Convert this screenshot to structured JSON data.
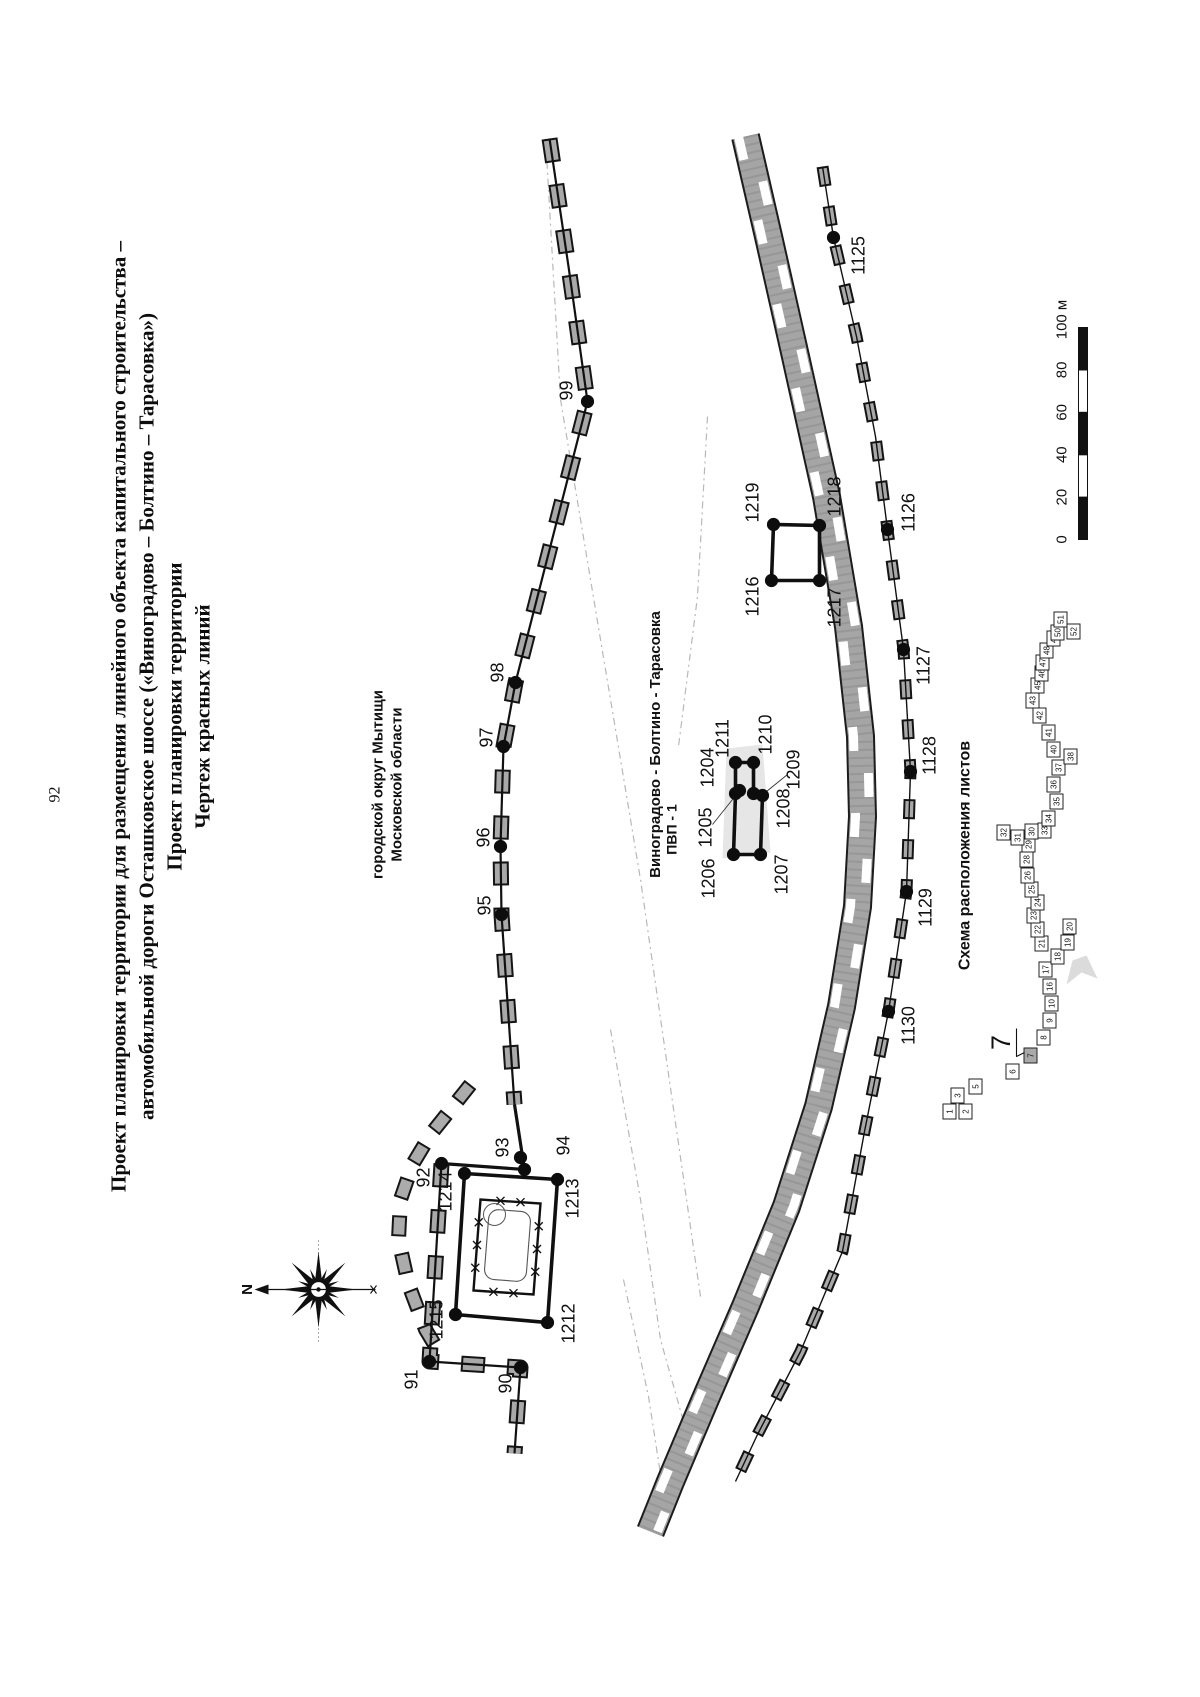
{
  "page": {
    "number": "92"
  },
  "title": {
    "line1": "Проект планировки территории для размещения линейного объекта капитального строительства –",
    "line2": "автомобильной дороги Осташковское шоссе («Виноградово – Болтино – Тарасовка»)",
    "line3": "Проект планировки территории",
    "line4": "Чертеж красных линий"
  },
  "map": {
    "district_label_line1": "городской округ Мытищи",
    "district_label_line2": "Московской области",
    "route_label": "Виноградово - Болтино - Тарасовка",
    "pvp_label": "ПВП - 1",
    "compass_label": "N",
    "points": [
      {
        "label": "90",
        "x": 329,
        "y": 520,
        "lx": 313,
        "ly": 505
      },
      {
        "label": "91",
        "x": 335,
        "y": 429,
        "lx": 317,
        "ly": 411
      },
      {
        "label": "92",
        "x": 533,
        "y": 441,
        "lx": 519,
        "ly": 423
      },
      {
        "label": "93",
        "x": 539,
        "y": 520,
        "lx": 549,
        "ly": 502
      },
      {
        "label": "94",
        "x": 527,
        "y": 524,
        "lx": 551,
        "ly": 563
      },
      {
        "label": "95",
        "x": 782,
        "y": 501,
        "lx": 791,
        "ly": 484
      },
      {
        "label": "96",
        "x": 850,
        "y": 500,
        "lx": 859,
        "ly": 483
      },
      {
        "label": "97",
        "x": 950,
        "y": 503,
        "lx": 959,
        "ly": 486
      },
      {
        "label": "98",
        "x": 1014,
        "y": 515,
        "lx": 1024,
        "ly": 497
      },
      {
        "label": "99",
        "x": 1295,
        "y": 587,
        "lx": 1306,
        "ly": 566
      },
      {
        "label": "1125",
        "x": 1459,
        "y": 833,
        "lx": 1441,
        "ly": 858
      },
      {
        "label": "1126",
        "x": 1167,
        "y": 887,
        "lx": 1184,
        "ly": 908
      },
      {
        "label": "1127",
        "x": 1047,
        "y": 903,
        "lx": 1031,
        "ly": 923
      },
      {
        "label": "1128",
        "x": 925,
        "y": 910,
        "lx": 941,
        "ly": 929
      },
      {
        "label": "1129",
        "x": 805,
        "y": 906,
        "lx": 789,
        "ly": 925
      },
      {
        "label": "1130",
        "x": 685,
        "y": 888,
        "lx": 671,
        "ly": 908
      },
      {
        "label": "1204",
        "x": 903,
        "y": 735,
        "lx": 929,
        "ly": 707
      },
      {
        "label": "1205",
        "x": 906,
        "y": 739,
        "lx": 869,
        "ly": 705
      },
      {
        "label": "1206",
        "x": 842,
        "y": 733,
        "lx": 818,
        "ly": 708
      },
      {
        "label": "1207",
        "x": 842,
        "y": 760,
        "lx": 822,
        "ly": 781
      },
      {
        "label": "1208",
        "x": 903,
        "y": 753,
        "lx": 888,
        "ly": 783
      },
      {
        "label": "1209",
        "x": 901,
        "y": 762,
        "lx": 927,
        "ly": 793
      },
      {
        "label": "1210",
        "x": 934,
        "y": 753,
        "lx": 962,
        "ly": 765
      },
      {
        "label": "1211",
        "x": 934,
        "y": 735,
        "lx": 958,
        "ly": 722
      },
      {
        "label": "1212",
        "x": 374,
        "y": 547,
        "lx": 373,
        "ly": 568
      },
      {
        "label": "1213",
        "x": 517,
        "y": 557,
        "lx": 498,
        "ly": 572
      },
      {
        "label": "1214",
        "x": 523,
        "y": 464,
        "lx": 505,
        "ly": 445
      },
      {
        "label": "1215",
        "x": 382,
        "y": 455,
        "lx": 377,
        "ly": 436
      },
      {
        "label": "1216",
        "x": 1116,
        "y": 771,
        "lx": 1100,
        "ly": 752
      },
      {
        "label": "1217",
        "x": 1116,
        "y": 819,
        "lx": 1089,
        "ly": 834
      },
      {
        "label": "1218",
        "x": 1171,
        "y": 819,
        "lx": 1200,
        "ly": 834
      },
      {
        "label": "1219",
        "x": 1172,
        "y": 773,
        "lx": 1194,
        "ly": 752
      }
    ]
  },
  "scale_bar": {
    "u0": 1157,
    "w": 1078,
    "seg": 42.4,
    "h": 9,
    "labels": [
      "0",
      "20",
      "40",
      "60",
      "80",
      "100 м"
    ]
  },
  "scheme": {
    "title": "Схема расположения листов",
    "callout": "7",
    "sheets": [
      {
        "n": "1",
        "u": 585,
        "w": 949
      },
      {
        "n": "2",
        "u": 585,
        "w": 965
      },
      {
        "n": "3",
        "u": 601,
        "w": 957
      },
      {
        "n": "5",
        "u": 610,
        "w": 975
      },
      {
        "n": "6",
        "u": 625,
        "w": 1012
      },
      {
        "n": "7",
        "u": 641,
        "w": 1030,
        "hl": true
      },
      {
        "n": "8",
        "u": 659,
        "w": 1043
      },
      {
        "n": "9",
        "u": 676,
        "w": 1049
      },
      {
        "n": "10",
        "u": 693,
        "w": 1051
      },
      {
        "n": "16",
        "u": 710,
        "w": 1049
      },
      {
        "n": "17",
        "u": 727,
        "w": 1045
      },
      {
        "n": "18",
        "u": 740,
        "w": 1057
      },
      {
        "n": "19",
        "u": 754,
        "w": 1067
      },
      {
        "n": "20",
        "u": 770,
        "w": 1069
      },
      {
        "n": "21",
        "u": 753,
        "w": 1041
      },
      {
        "n": "22",
        "u": 767,
        "w": 1037
      },
      {
        "n": "23",
        "u": 781,
        "w": 1033
      },
      {
        "n": "24",
        "u": 794,
        "w": 1037
      },
      {
        "n": "25",
        "u": 807,
        "w": 1031
      },
      {
        "n": "26",
        "u": 821,
        "w": 1027
      },
      {
        "n": "28",
        "u": 837,
        "w": 1026
      },
      {
        "n": "29",
        "u": 852,
        "w": 1028
      },
      {
        "n": "30",
        "u": 865,
        "w": 1031
      },
      {
        "n": "31",
        "u": 859,
        "w": 1017
      },
      {
        "n": "32",
        "u": 864,
        "w": 1003
      },
      {
        "n": "33",
        "u": 866,
        "w": 1044
      },
      {
        "n": "34",
        "u": 878,
        "w": 1048
      },
      {
        "n": "35",
        "u": 895,
        "w": 1056
      },
      {
        "n": "36",
        "u": 912,
        "w": 1053
      },
      {
        "n": "37",
        "u": 929,
        "w": 1058
      },
      {
        "n": "38",
        "u": 940,
        "w": 1070
      },
      {
        "n": "40",
        "u": 947,
        "w": 1053
      },
      {
        "n": "41",
        "u": 964,
        "w": 1048
      },
      {
        "n": "42",
        "u": 981,
        "w": 1039
      },
      {
        "n": "43",
        "u": 996,
        "w": 1032
      },
      {
        "n": "45",
        "u": 1011,
        "w": 1037
      },
      {
        "n": "46",
        "u": 1023,
        "w": 1041
      },
      {
        "n": "47",
        "u": 1034,
        "w": 1042
      },
      {
        "n": "48",
        "u": 1046,
        "w": 1046
      },
      {
        "n": "49",
        "u": 1058,
        "w": 1053
      },
      {
        "n": "50",
        "u": 1064,
        "w": 1057
      },
      {
        "n": "51",
        "u": 1077,
        "w": 1060
      },
      {
        "n": "52",
        "u": 1065,
        "w": 1073
      }
    ]
  },
  "colors": {
    "ink": "#111111",
    "band_gray": "#a5a5a5",
    "hatch_gray": "#a9a9a9",
    "faint": "#b8b8b8",
    "paper": "#ffffff"
  },
  "geometry": {
    "faint_lines": [
      [
        [
          400,
          700
        ],
        [
          817,
          640
        ],
        [
          1297,
          560
        ],
        [
          1560,
          545
        ]
      ],
      [
        [
          667,
          610
        ],
        [
          497,
          640
        ],
        [
          357,
          660
        ],
        [
          250,
          690
        ]
      ],
      [
        [
          1280,
          707
        ],
        [
          1100,
          697
        ],
        [
          950,
          678
        ]
      ],
      [
        [
          417,
          623
        ],
        [
          300,
          648
        ],
        [
          190,
          665
        ]
      ]
    ],
    "road_band": [
      [
        1560,
        745
      ],
      [
        1460,
        768
      ],
      [
        1340,
        795
      ],
      [
        1200,
        826
      ],
      [
        1070,
        848
      ],
      [
        960,
        860
      ],
      [
        880,
        862
      ],
      [
        790,
        857
      ],
      [
        690,
        841
      ],
      [
        590,
        818
      ],
      [
        490,
        786
      ],
      [
        390,
        745
      ],
      [
        300,
        706
      ],
      [
        215,
        670
      ],
      [
        165,
        650
      ]
    ],
    "axis_line": [
      [
        1530,
        822
      ],
      [
        1459,
        833
      ],
      [
        1360,
        856
      ],
      [
        1260,
        875
      ],
      [
        1167,
        887
      ],
      [
        1047,
        903
      ],
      [
        925,
        910
      ],
      [
        805,
        906
      ],
      [
        685,
        888
      ],
      [
        565,
        864
      ],
      [
        445,
        842
      ],
      [
        345,
        800
      ],
      [
        262,
        757
      ],
      [
        215,
        735
      ]
    ],
    "red_line_main": [
      [
        1558,
        549
      ],
      [
        1430,
        568
      ],
      [
        1295,
        587
      ],
      [
        1014,
        515
      ],
      [
        950,
        503
      ],
      [
        850,
        500
      ],
      [
        782,
        501
      ],
      [
        592,
        514
      ]
    ],
    "red_line_plain": [
      [
        592,
        514
      ],
      [
        527,
        524
      ],
      [
        533,
        441
      ]
    ],
    "red_line_branch": [
      [
        533,
        441
      ],
      [
        335,
        429
      ],
      [
        329,
        520
      ],
      [
        243,
        514
      ]
    ],
    "arc_road": [
      [
        612,
        470
      ],
      [
        587,
        450
      ],
      [
        562,
        430
      ],
      [
        532,
        412
      ],
      [
        497,
        400
      ],
      [
        457,
        398
      ],
      [
        412,
        408
      ],
      [
        367,
        425
      ],
      [
        342,
        440
      ]
    ],
    "parcel_rect": [
      [
        382,
        455
      ],
      [
        523,
        464
      ],
      [
        517,
        557
      ],
      [
        374,
        547
      ]
    ],
    "fence_rect": [
      [
        406,
        473
      ],
      [
        497,
        480
      ],
      [
        493,
        540
      ],
      [
        402,
        533
      ]
    ],
    "quad_rect": [
      [
        1116,
        771
      ],
      [
        1172,
        773
      ],
      [
        1171,
        819
      ],
      [
        1116,
        819
      ]
    ],
    "pvp_segments": [
      [
        [
          934,
          735
        ],
        [
          934,
          753
        ]
      ],
      [
        [
          934,
          735
        ],
        [
          903,
          735
        ]
      ],
      [
        [
          934,
          753
        ],
        [
          903,
          753
        ]
      ],
      [
        [
          903,
          735
        ],
        [
          842,
          733
        ]
      ],
      [
        [
          903,
          753
        ],
        [
          901,
          762
        ]
      ],
      [
        [
          901,
          762
        ],
        [
          842,
          760
        ]
      ],
      [
        [
          842,
          733
        ],
        [
          842,
          760
        ]
      ]
    ],
    "pvp_blob": [
      [
        838,
        722
      ],
      [
        948,
        726
      ],
      [
        952,
        762
      ],
      [
        844,
        770
      ]
    ],
    "leaders": [
      [
        [
          872,
          712
        ],
        [
          902,
          736
        ]
      ],
      [
        [
          922,
          787
        ],
        [
          905,
          766
        ]
      ]
    ],
    "callout_leader": [
      [
        668,
        1016
      ],
      [
        640,
        1016
      ],
      [
        644,
        1024
      ]
    ],
    "smudge": [
      [
        712,
        1066
      ],
      [
        736,
        1072
      ],
      [
        741,
        1086
      ],
      [
        718,
        1097
      ],
      [
        724,
        1081
      ]
    ],
    "compass": {
      "cx": 407,
      "cy": 318,
      "arrow_top": 262,
      "arrow_bottom": 375
    }
  }
}
